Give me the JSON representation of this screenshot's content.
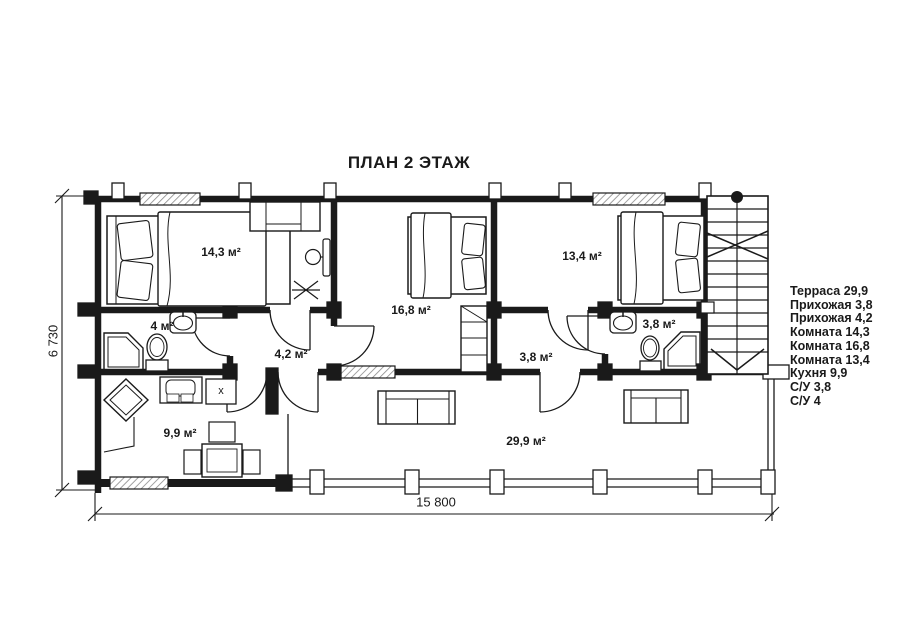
{
  "title": "ПЛАН 2 ЭТАЖ",
  "rooms": {
    "room1": {
      "label": "14,3 м²"
    },
    "room2": {
      "label": "16,8 м²"
    },
    "room3": {
      "label": "13,4 м²"
    },
    "bath1": {
      "label": "4 м²"
    },
    "hall1": {
      "label": "4,2 м²"
    },
    "hall2": {
      "label": "3,8 м²"
    },
    "bath2": {
      "label": "3,8 м²"
    },
    "kitchen": {
      "label": "9,9 м²"
    },
    "terrace": {
      "label": "29,9 м²"
    }
  },
  "dimensions": {
    "overall_width": "15 800",
    "overall_depth": "6 730"
  },
  "legend": {
    "items": [
      "Терраса 29,9",
      "Прихожая 3,8",
      "Прихожая 4,2",
      "Комната 14,3",
      "Комната 16,8",
      "Комната 13,4",
      "Кухня 9,9",
      "С/У 3,8",
      "С/У 4"
    ]
  },
  "markers": {
    "stove": "x"
  },
  "colors": {
    "line": "#1a1a1a",
    "background": "#ffffff",
    "window_hatch": "#8a8a8a"
  }
}
